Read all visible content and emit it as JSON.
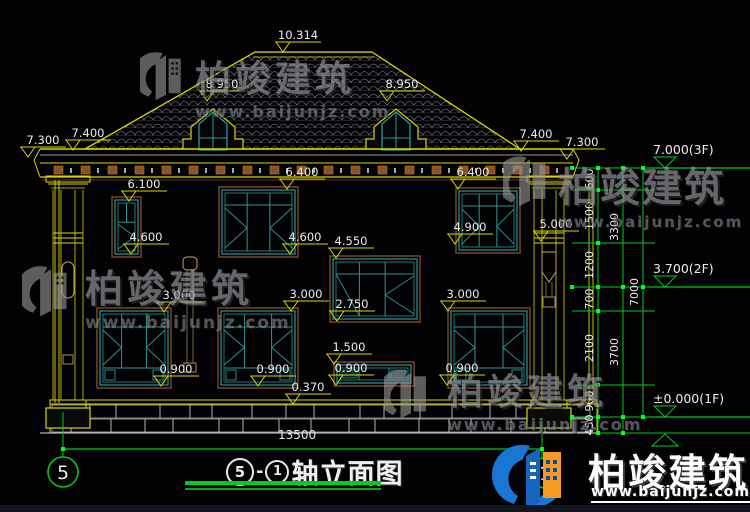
{
  "drawing_title": {
    "axis_left": "5",
    "dash": "-",
    "axis_right": "1",
    "name": "轴立面图"
  },
  "grid_bubbles": {
    "left": "5",
    "right": "1"
  },
  "bottom_dimension": "13500",
  "elevation_marks": [
    [
      "10.314",
      283,
      52
    ],
    [
      "8.950",
      207,
      101
    ],
    [
      "8.950",
      387,
      101
    ],
    [
      "7.300",
      28,
      157
    ],
    [
      "7.400",
      73,
      150
    ],
    [
      "7.400",
      521,
      151
    ],
    [
      "7.300",
      567,
      159
    ],
    [
      "6.100",
      129,
      201
    ],
    [
      "6.400",
      287,
      189
    ],
    [
      "6.400",
      458,
      189
    ],
    [
      "4.600",
      131,
      254
    ],
    [
      "4.600",
      290,
      254
    ],
    [
      "4.550",
      336,
      258
    ],
    [
      "4.900",
      455,
      244
    ],
    [
      "5.000",
      541,
      241
    ],
    [
      "3.000",
      164,
      312
    ],
    [
      "3.000",
      291,
      311
    ],
    [
      "2.750",
      337,
      321
    ],
    [
      "3.000",
      448,
      311
    ],
    [
      "1.500",
      334,
      364
    ],
    [
      "0.900",
      161,
      386
    ],
    [
      "0.900",
      258,
      386
    ],
    [
      "0.900",
      336,
      385
    ],
    [
      "0.900",
      447,
      385
    ],
    [
      "0.370",
      293,
      404
    ]
  ],
  "chain_dims": [
    [
      "600",
      598,
      179
    ],
    [
      "1500",
      598,
      216
    ],
    [
      "1200",
      598,
      265
    ],
    [
      "700",
      598,
      299
    ],
    [
      "2100",
      598,
      348
    ],
    [
      "900",
      598,
      401
    ],
    [
      "450",
      598,
      425
    ],
    [
      "3300",
      623,
      227
    ],
    [
      "3700",
      623,
      352
    ],
    [
      "7000",
      643,
      292
    ]
  ],
  "level_marks": [
    {
      "label": "7.000(3F)",
      "y": 168,
      "flip": false
    },
    {
      "label": "3.700(2F)",
      "y": 287,
      "flip": false
    },
    {
      "label": "±0.000(1F)",
      "y": 417,
      "flip": false
    },
    {
      "label": "",
      "y": 434,
      "flip": true
    }
  ],
  "watermark": {
    "brand": "柏竣建筑",
    "url": "www.baijunjz.com"
  },
  "logo": {
    "brand": "柏竣建筑",
    "url": "www.baijunjz.com"
  },
  "colors": {
    "cad_yellow": "#d6d600",
    "cad_green": "#00c81e",
    "teal": "#2d9595",
    "frame_brown": "#7a4520",
    "dentil_brown": "#8a5320",
    "stone_grey": "#c4c4c4",
    "text_white": "#ececec",
    "watermark_grey": "#97979c",
    "logo_blue": "#1565c0",
    "logo_orange": "#f59a23",
    "underline_green": "#00cc22"
  }
}
